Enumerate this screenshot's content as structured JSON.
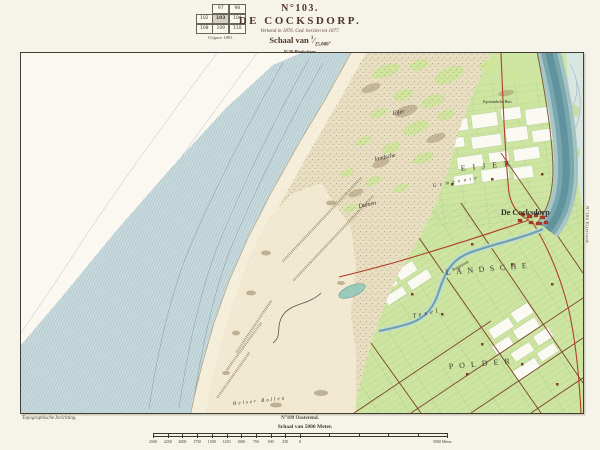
{
  "header": {
    "index_table": {
      "rows": [
        [
          "",
          "97",
          "98"
        ],
        [
          "102",
          "103",
          "104"
        ],
        [
          "108",
          "109",
          "110"
        ]
      ],
      "highlight": "103",
      "caption": "Uitgave 1881."
    },
    "sheet_no": "N°103.",
    "title": "DE COCKSDORP.",
    "survey_note": "Verkend in 1876. Ged. herzien tot 1877.",
    "scale_prefix": "Schaal van",
    "scale_num": "1",
    "scale_den": "25.000",
    "edition_note": "N°30 Bladwijzer."
  },
  "map": {
    "labels": {
      "dunes_line1": "Eijer",
      "dunes_line2": "landsche",
      "dunes_line3": "Duinen",
      "polder_word1": "EIJER",
      "gemeente": "Gemeente",
      "town": "De Cocksdorp",
      "polder_word2": "LANDSCHE",
      "texel": "Texel",
      "polder_word3": "POLDER",
      "sand_flat": "Helser Bollen",
      "stream": "Roggesloot",
      "farm": "Eijerlandsche Huis"
    },
    "margins": {
      "right_sheet": "N°104 Eijerland.",
      "bottom_left_credit": "Topographische Inrichting.",
      "bottom_sheet": "N°109 Oosterend."
    },
    "colors": {
      "sea_band": "#c9dadd",
      "sea_hatch": "#7fa3ad",
      "beach": "#f5eeda",
      "dunes": "#e9dfc3",
      "dune_green": "#cfe79c",
      "polder_green": "#cde5a1",
      "water_channel": "#78a7ae",
      "road_red": "#b0402c",
      "road_brown": "#7c3f2c",
      "town_red": "#b03a2a",
      "title_ink": "#4f362b"
    }
  },
  "scalebar": {
    "title": "Schaal van 5000 Meter.",
    "ticks": [
      "2500",
      "2250",
      "2000",
      "1750",
      "1500",
      "1250",
      "1000",
      "750",
      "500",
      "250",
      "0"
    ],
    "end_label": "5000 Meter."
  }
}
